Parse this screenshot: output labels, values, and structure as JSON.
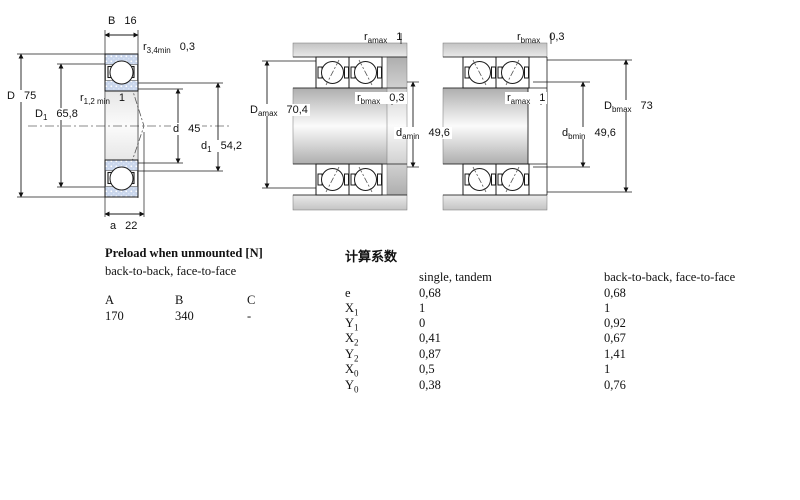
{
  "figures": {
    "left": {
      "name": "single bearing cross-section",
      "B": {
        "base": "B",
        "value": "16"
      },
      "r34": {
        "base": "r",
        "sub": "3,4min",
        "value": "0,3"
      },
      "D": {
        "base": "D",
        "value": "75"
      },
      "D1": {
        "base": "D",
        "sub": "1",
        "value": "65,8"
      },
      "r12": {
        "base": "r",
        "sub": "1,2 min",
        "value": "1"
      },
      "d": {
        "base": "d",
        "value": "45"
      },
      "d1": {
        "base": "d",
        "sub": "1",
        "value": "54,2"
      },
      "a": {
        "base": "a",
        "value": "22"
      }
    },
    "middle": {
      "name": "paired bearings back-to-back mounting dimensions",
      "ramax": {
        "base": "r",
        "sub": "amax",
        "value": "1"
      },
      "Damax": {
        "base": "D",
        "sub": "amax",
        "value": "70,4"
      },
      "rbmax": {
        "base": "r",
        "sub": "bmax",
        "value": "0,3"
      },
      "damin": {
        "base": "d",
        "sub": "amin",
        "value": "49,6"
      }
    },
    "right": {
      "name": "paired bearings face-to-face mounting dimensions",
      "rbmax": {
        "base": "r",
        "sub": "bmax",
        "value": "0,3"
      },
      "ramax": {
        "base": "r",
        "sub": "amax",
        "value": "1"
      },
      "dbmin": {
        "base": "d",
        "sub": "bmin",
        "value": "49,6"
      },
      "Dbmax": {
        "base": "D",
        "sub": "bmax",
        "value": "73"
      }
    }
  },
  "colors": {
    "bearing_ring_fill": "#c9d6ec",
    "line": "#1a1a1a",
    "shaft_grey": "#b0b0b0"
  },
  "preload_table": {
    "title": "Preload when unmounted [N]",
    "subtitle": "back-to-back, face-to-face",
    "columns": [
      "A",
      "B",
      "C"
    ],
    "values": [
      "170",
      "340",
      "-"
    ]
  },
  "factors_table": {
    "title": "计算系数",
    "col1_header": "single, tandem",
    "col2_header": "back-to-back, face-to-face",
    "rows": [
      {
        "base": "e",
        "sub": "",
        "v1": "0,68",
        "v2": "0,68"
      },
      {
        "base": "X",
        "sub": "1",
        "v1": "1",
        "v2": "1"
      },
      {
        "base": "Y",
        "sub": "1",
        "v1": "0",
        "v2": "0,92"
      },
      {
        "base": "X",
        "sub": "2",
        "v1": "0,41",
        "v2": "0,67"
      },
      {
        "base": "Y",
        "sub": "2",
        "v1": "0,87",
        "v2": "1,41"
      },
      {
        "base": "X",
        "sub": "0",
        "v1": "0,5",
        "v2": "1"
      },
      {
        "base": "Y",
        "sub": "0",
        "v1": "0,38",
        "v2": "0,76"
      }
    ]
  }
}
